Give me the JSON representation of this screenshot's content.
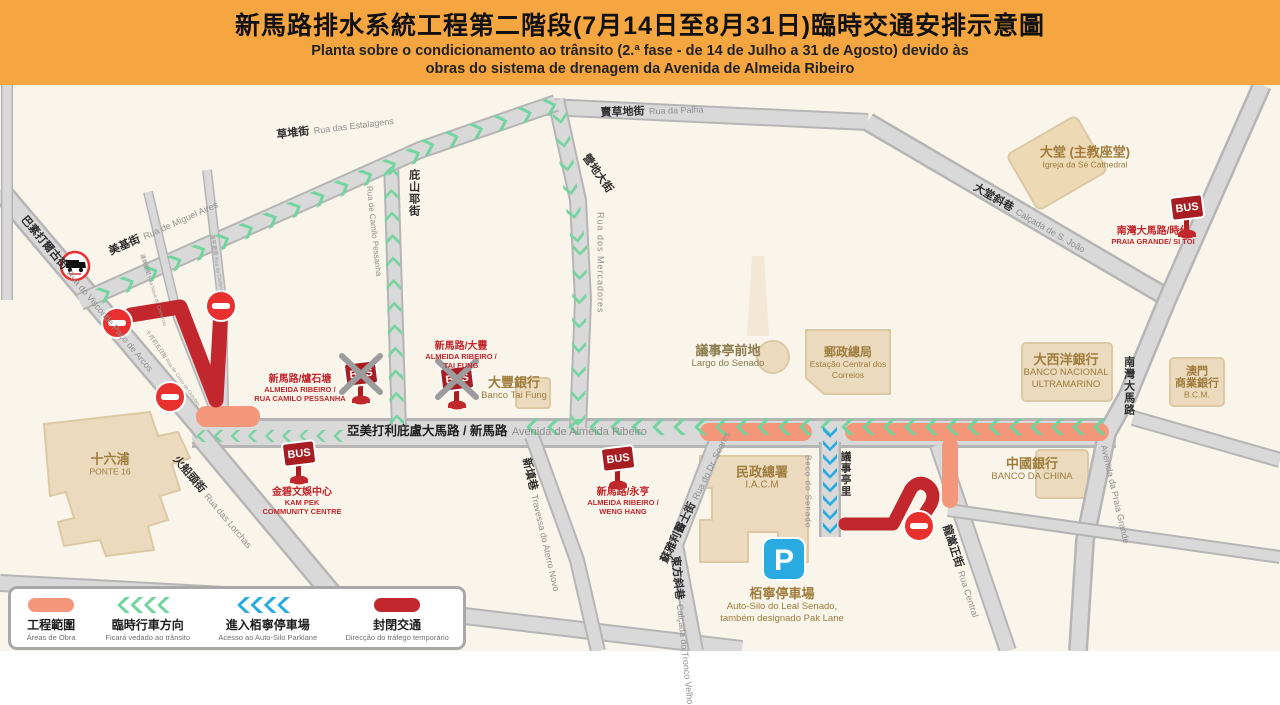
{
  "colors": {
    "header_orange": "#F6A640",
    "work_area": "#F5977B",
    "temp_direction_green": "#72D49E",
    "parking_access_blue": "#29ABE2",
    "closed_red": "#C1272D",
    "no_entry_red": "#E8312E",
    "road_fill": "#D9D9D9",
    "road_casing": "#B5B5B5",
    "building_tan": "#EBDABD"
  },
  "header": {
    "title_zh": "新馬路排水系統工程第二階段(7月14日至8月31日)臨時交通安排示意圖",
    "subtitle_pt_1": "Planta sobre o condicionamento ao trânsito (2.ª fase - de 14 de Julho a 31 de Agosto) devido às",
    "subtitle_pt_2": "obras do sistema de drenagem da Avenida de Almeida Ribeiro"
  },
  "legend": {
    "work": {
      "zh": "工程範圍",
      "pt": "Áreas de Obra"
    },
    "temp_direction": {
      "zh": "臨時行車方向",
      "pt": "Ficará vedado ao trânsito"
    },
    "parking_access": {
      "zh": "進入栢寧停車場",
      "pt": "Acesso ao Auto-Silo Parklane"
    },
    "closed": {
      "zh": "封閉交通",
      "pt": "Direcção do tráfego temporário"
    }
  },
  "map": {
    "bus_icon_label": "BUS",
    "parking_icon_label": "P",
    "streets": {
      "estalagens": {
        "zh": "草堆街",
        "pt": "Rua das Estalagens"
      },
      "palha": {
        "zh": "賣草地街",
        "pt": "Rua da Palha"
      },
      "miguel_aires": {
        "zh": "美基街",
        "pt": "Rua de Miguel Aires"
      },
      "camilo_pessanha": {
        "zh": "庇山耶街",
        "pt": "Rua de Camilo Pessanha"
      },
      "mercadores": {
        "zh": "營地大街",
        "pt": "Rua dos Mercadores"
      },
      "almeida_ribeiro": {
        "zh": "亞美打利庇盧大馬路 / 新馬路",
        "pt": "Avenida de Almeida Ribeiro"
      },
      "visconde": {
        "zh": "巴素打爾古街",
        "pt": "Rua do Visconde Paço de Arcos"
      },
      "lorchas": {
        "zh": "火船頭街",
        "pt": "Rua das Lorchas"
      },
      "aterro_novo": {
        "zh": "新填巷",
        "pt": "Travessa do Aterro Novo"
      },
      "dr_soares": {
        "zh": "蘇雅利醫士街",
        "pt": "Rua do Dr. Soares"
      },
      "tronco_velho": {
        "zh": "東方斜巷",
        "pt": "Calçada do Tronco Velho"
      },
      "beco_senado_pt": {
        "zh": "議事亭里",
        "pt": "Beco do Senado"
      },
      "rua_central": {
        "zh": "龍嵩正街",
        "pt": "Rua Central"
      },
      "praia_grande": {
        "zh": "南灣大馬路",
        "pt": "Avenida da Praia Grande"
      },
      "sao_joao": {
        "zh": "大堂斜巷",
        "pt": "Calçada de S. João"
      },
      "comercio": {
        "zh": "通商新街",
        "pt": "Rua Nova do Comércio"
      },
      "caldeira": {
        "zh": "清平直街",
        "pt": "Rua da Caldeira"
      },
      "cinco_outubro": {
        "zh": "十月初五日街",
        "pt": "Rua de Cinco de Outubro"
      }
    },
    "landmarks": {
      "ponte16": {
        "zh": "十六浦",
        "pt": "PONTE 16"
      },
      "cathedral": {
        "zh": "大堂 (主教座堂)",
        "pt": "Igreja da Sé Cathedral"
      },
      "post_office": {
        "zh": "郵政總局",
        "pt1": "Estação Central dos",
        "pt2": "Correios"
      },
      "largo_senado": {
        "zh": "議事亭前地",
        "pt": "Largo do Senado"
      },
      "iacm": {
        "zh": "民政總署",
        "pt": "I.A.C.M"
      },
      "bnu": {
        "zh": "大西洋銀行",
        "pt1": "BANCO NACIONAL",
        "pt2": "ULTRAMARINO"
      },
      "bcm": {
        "zh1": "澳門",
        "zh2": "商業銀行",
        "pt": "B.C.M."
      },
      "boc": {
        "zh": "中國銀行",
        "pt": "BANCO DA CHINA"
      },
      "tai_fung": {
        "zh": "大豐銀行",
        "pt": "Banco Tai Fung"
      },
      "parking": {
        "zh": "栢寧停車場",
        "pt1": "Auto-Silo do Leal Senado,",
        "pt2": "também designado Pak Lane"
      }
    },
    "bus_stops": {
      "camilo": {
        "zh": "新馬路/爐石塘",
        "pt1": "ALMEIDA RIBEIRO /",
        "pt2": "RUA CAMILO PESSANHA"
      },
      "tai_fung": {
        "zh": "新馬路/大豐",
        "pt1": "ALMEIDA RIBEIRO /",
        "pt2": "TAI FUNG"
      },
      "kam_pek": {
        "zh": "金碧文娛中心",
        "pt1": "KAM PEK",
        "pt2": "COMMUNITY CENTRE"
      },
      "weng_hang": {
        "zh": "新馬路/永亨",
        "pt1": "ALMEIDA RIBEIRO /",
        "pt2": "WENG HANG"
      },
      "praia_grande": {
        "zh": "南灣大馬路/時代",
        "pt1": "PRAIA GRANDE/ SI TOI",
        "pt2": ""
      }
    }
  }
}
